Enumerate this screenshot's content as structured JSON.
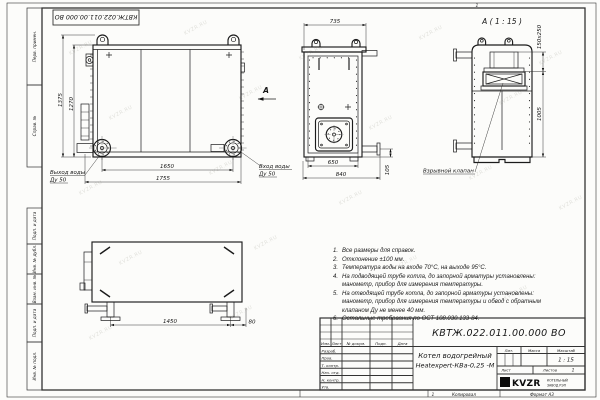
{
  "page": {
    "watermark": "KVZR.RU",
    "zone_marker": "1",
    "copied_label": "Копировал",
    "format_label": "Формат А3",
    "top_stamp": "КВТЖ.022.011.00.000 ВО"
  },
  "margin_column": {
    "perv_primen": "Перв. примен.",
    "sprav_no": "Справ. №",
    "podp_data_1": "Подп. и дата",
    "inv_dubl": "Инв. № дубл.",
    "vzam_inv": "Взам. инв. №",
    "podp_data_2": "Подп. и дата",
    "inv_podl": "Инв. № подл."
  },
  "views": {
    "front": {
      "dim_height_total": "1375",
      "dim_height_inner": "1270",
      "dim_width_nozzles": "1650",
      "dim_width_total": "1755",
      "outlet_label_line1": "Выход воды",
      "outlet_label_line2": "Ду 50",
      "inlet_label_line1": "Вход воды",
      "inlet_label_line2": "Ду 50",
      "view_arrow_label": "А"
    },
    "side": {
      "dim_width_top": "735",
      "dim_width_inner": "650",
      "dim_width_total": "840",
      "dim_pipe_height": "105"
    },
    "detail_a": {
      "title": "А ( 1 : 15 )",
      "dim_valve_section": "150x250",
      "dim_height": "1005",
      "valve_label": "Взрывной клапан"
    },
    "plan": {
      "dim_legs_span": "1450",
      "dim_offset": "80"
    }
  },
  "notes": [
    {
      "num": "1.",
      "text": "Все размеры для справок."
    },
    {
      "num": "2.",
      "text": "Отклонение ±100 мм."
    },
    {
      "num": "3.",
      "text": "Температура воды на входе 70°С, на выходе 95°С."
    },
    {
      "num": "4.",
      "text": "На подводящей трубе котла, до запорной арматуры установлены: манометр, прибор для измерения температуры."
    },
    {
      "num": "5.",
      "text": "На отводящей трубе котла, до запорной арматуры установлены: манометр, прибор для измерения температуры и обвод с обратным клапаном Ду не менее 40 мм."
    },
    {
      "num": "6.",
      "text": "Остальные требования по ОСТ 108.030.133-84."
    }
  ],
  "title_block": {
    "designation": "КВТЖ.022.011.00.000 ВО",
    "product_name_line1": "Котел водогрейный",
    "product_name_line2": "Heatexpert-КВа-0,25 -М",
    "col_izm": "Изм.",
    "col_list": "Лист",
    "col_doc": "№ докум.",
    "col_podp": "Подп.",
    "col_data": "Дата",
    "row_razrab": "Разраб.",
    "row_prov": "Пров.",
    "row_tkontr": "Т. контр.",
    "row_nachotd": "Нач. отд.",
    "row_nkontr": "Н. контр.",
    "row_utv": "Утв.",
    "lit_label": "Лит.",
    "massa_label": "Масса",
    "scale_label": "Масштаб",
    "scale_value": "1 : 15",
    "sheet_label": "Лист",
    "sheets_label": "Листов",
    "sheets_value": "1",
    "logo_text": "KVZR",
    "company_line1": "КОТЕЛЬНЫЙ",
    "company_line2": "ЗАВОД РЭП"
  }
}
